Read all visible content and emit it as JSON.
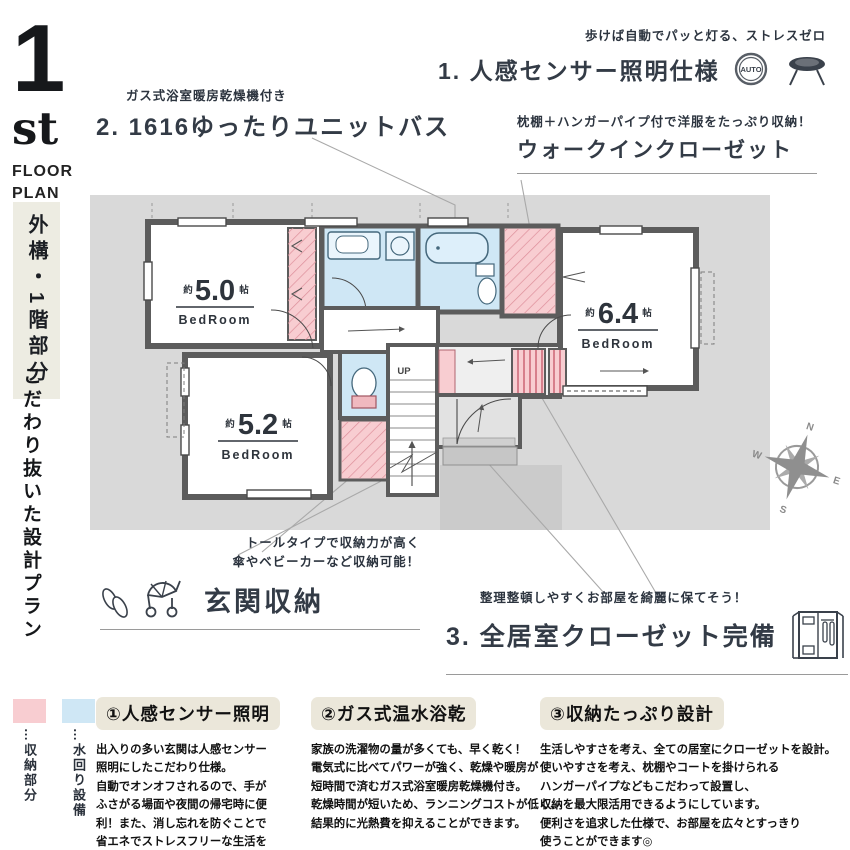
{
  "header": {
    "floor_number": "1",
    "floor_suffix": "st",
    "floor_label": "FLOOR\nPLAN"
  },
  "sidebar": {
    "tag": "外構・1階部分",
    "caption": "こだわり抜いた設計プラン"
  },
  "callouts": {
    "sensor": {
      "sub": "歩けば自動でパッと灯る、ストレスゼロ",
      "title": "1. 人感センサー照明仕様",
      "auto_icon_label": "AUTO"
    },
    "bath": {
      "sub": "ガス式浴室暖房乾燥機付き",
      "title": "2. 1616ゆったりユニットバス"
    },
    "wic": {
      "sub": "枕棚＋ハンガーパイプ付で洋服をたっぷり収納！",
      "title": "ウォークインクローゼット"
    },
    "entrance": {
      "sub": "トールタイプで収納力が高く\n傘やベビーカーなど収納可能！",
      "title": "玄関収納"
    },
    "closet": {
      "sub": "整理整頓しやすくお部屋を綺麗に保てそう！",
      "title": "3. 全居室クローゼット完備"
    }
  },
  "plan": {
    "rooms": [
      {
        "size_prefix": "約",
        "size": "5.0",
        "size_unit": "帖",
        "name": "BedRoom"
      },
      {
        "size_prefix": "約",
        "size": "5.2",
        "size_unit": "帖",
        "name": "BedRoom"
      },
      {
        "size_prefix": "約",
        "size": "6.4",
        "size_unit": "帖",
        "name": "BedRoom"
      }
    ],
    "stairs_label": "UP",
    "compass": {
      "n": "N",
      "e": "E",
      "s": "S",
      "w": "W"
    }
  },
  "legend": {
    "items": [
      {
        "label": "…収納部分",
        "color": "#f8cdd1"
      },
      {
        "label": "…水回り設備",
        "color": "#cfe7f5"
      }
    ]
  },
  "features": {
    "items": [
      {
        "title": "①人感センサー照明",
        "body": "出入りの多い玄関は人感センサー\n照明にしたこだわり仕様。\n自動でオンオフされるので、手が\nふさがる場面や夜間の帰宅時に便\n利！また、消し忘れを防ぐことで\n省エネでストレスフリーな生活を\n実現できそうです♪"
      },
      {
        "title": "②ガス式温水浴乾",
        "body": "家族の洗濯物の量が多くても、早く乾く！\n電気式に比べてパワーが強く、乾燥や暖房が\n短時間で済むガス式浴室暖房乾燥機付き。\n乾燥時間が短いため、ランニングコストが低く、\n結果的に光熱費を抑えることができます。"
      },
      {
        "title": "③収納たっぷり設計",
        "body": "生活しやすさを考え、全ての居室にクローゼットを設計。\n使いやすさを考え、枕棚やコートを掛けられる\nハンガーパイプなどもこだわって設置し、\n収納を最大限活用できるようにしています。\n便利さを追求した仕様で、お部屋を広々とすっきり\n使うことができます◎"
      }
    ]
  },
  "colors": {
    "storage_pink": "#f8cdd1",
    "water_blue": "#cfe7f5",
    "wall_gray": "#5c5c5c",
    "site_gray": "#d9d9d9",
    "accent_dark": "#333b46",
    "header_cream": "#ebe7da",
    "tag_beige": "#edece2"
  }
}
